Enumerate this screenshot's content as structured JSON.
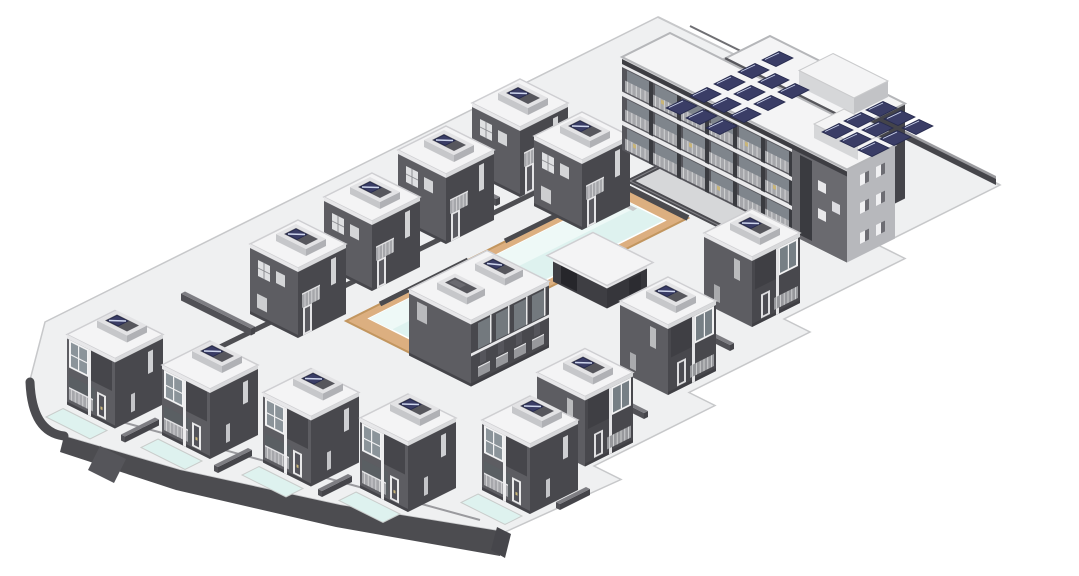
{
  "canvas": {
    "width": 1079,
    "height": 576,
    "background": "#ffffff"
  },
  "colors": {
    "pad": "#eff0f1",
    "pad_edge_line": "#c7c8ca",
    "curb": "#4c4c50",
    "curb_light": "#9a9a9e",
    "wall_dark": "#46464b",
    "wall_top": "#7e7e83",
    "villa_sw": "#5d5d62",
    "villa_se": "#48484d",
    "roof": "#f4f4f5",
    "roof_edge": "#cfcfd2",
    "parapet": "#e7e7e9",
    "well_ring_sw": "#c6c7ca",
    "well_ring_se": "#b0b1b5",
    "well_ring_top": "#e3e3e5",
    "well_dark": "#57575d",
    "solar": "#3a3d66",
    "solar_dark": "#262a4d",
    "solar_streak": "#cdd5ec",
    "glass": "#8b949a",
    "frame": "#f2f2f3",
    "railing": "#a6a7ab",
    "railing_line": "#d8d9da",
    "door_dark": "#53535a",
    "accent": "#c9b578",
    "pool_water": "#def2ef",
    "pool_light": "#eef9f7",
    "deck": "#dcaf80",
    "deck_edge": "#c2965f",
    "apt_facade": "#55555b",
    "apt_glass": "#7f858c",
    "apt_slab": "#e9e9eb",
    "apt_mullion": "#3a3b40",
    "apt_parapet": "#3e3e43",
    "tower_light": "#b7b8bc",
    "tower_sw": "#6a6a6f",
    "pit_floor": "#d6d7d9",
    "step_light": "#eeeeef",
    "step_dark": "#c6c7c9"
  },
  "iso": {
    "ox": 660,
    "oy": 16,
    "ux": 1,
    "uy": 0.5
  },
  "site": {
    "pad_path": "M658,17 L1000,185 L879,245.5 L905,258.5 L784,319 L810,332 L689,392.5 L715,405.5 L594,466 L621,479.5 L505,532 L340,505 L180,470 L64,436 Q30,432 30,380 L45,322 Z",
    "edge_face": [
      [
        64,
        436
      ],
      [
        180,
        470
      ],
      [
        340,
        505
      ],
      [
        505,
        532
      ],
      [
        500,
        556
      ],
      [
        336,
        527
      ],
      [
        176,
        490
      ],
      [
        60,
        452
      ]
    ],
    "cap_band": "M64,436 Q32,432 30,382",
    "corner_notch": [
      [
        497,
        527
      ],
      [
        511,
        534
      ],
      [
        505,
        558
      ],
      [
        491,
        550
      ]
    ],
    "road_stub": [
      [
        100,
        446
      ],
      [
        126,
        459
      ],
      [
        114,
        483
      ],
      [
        88,
        470
      ]
    ],
    "inner_curb": "M620,151 L128,392",
    "front_curb": "M115,420 L480,520",
    "ne_edge_line": [
      [
        658,
        17
      ],
      [
        1000,
        185
      ]
    ],
    "ne_edge_line2": [
      [
        690,
        26
      ],
      [
        850,
        105
      ]
    ],
    "ne_wall": [
      [
        852,
        106
      ],
      [
        996,
        178
      ],
      [
        996,
        185
      ],
      [
        852,
        113
      ]
    ],
    "ne_wall_top": [
      [
        850,
        103
      ],
      [
        996,
        176
      ],
      [
        996,
        179
      ],
      [
        850,
        106
      ]
    ]
  },
  "pool": {
    "deck": {
      "x": 148,
      "y": 188,
      "w": 68,
      "d": 274
    },
    "water": {
      "x": 157,
      "y": 202,
      "w": 50,
      "d": 246
    },
    "nw_walls": [
      [
        [
          620,
          184
        ],
        [
          505,
          241
        ]
      ],
      [
        [
          468,
          260
        ],
        [
          380,
          304
        ]
      ]
    ],
    "ne_wall": [
      [
        620,
        184
      ],
      [
        688,
        218
      ]
    ],
    "stairs": {
      "x": 596,
      "y": 188,
      "steps": 4
    }
  },
  "pit": {
    "x": 150,
    "y": 138,
    "w": 112,
    "d": 42
  },
  "villas": [
    {
      "id": "villa-top-1",
      "x": 93,
      "y": 455,
      "w": 48,
      "d": 48,
      "h": 70,
      "variant": "back",
      "pool": false
    },
    {
      "id": "villa-top-2",
      "x": 83,
      "y": 371,
      "w": 48,
      "d": 48,
      "h": 70,
      "variant": "back",
      "pool": false
    },
    {
      "id": "villa-top-3",
      "x": 73,
      "y": 287,
      "w": 48,
      "d": 48,
      "h": 70,
      "variant": "back",
      "pool": false
    },
    {
      "id": "villa-top-4",
      "x": 63,
      "y": 203,
      "w": 48,
      "d": 48,
      "h": 70,
      "variant": "back",
      "pool": false
    },
    {
      "id": "villa-top-5",
      "x": 127,
      "y": 205,
      "w": 48,
      "d": 48,
      "h": 70,
      "variant": "back",
      "pool": false
    },
    {
      "id": "villa-bottom-1",
      "x": 92,
      "y": 637,
      "w": 48,
      "d": 48,
      "h": 70,
      "variant": "front",
      "pool": true
    },
    {
      "id": "villa-bottom-2",
      "x": 170,
      "y": 620,
      "w": 48,
      "d": 48,
      "h": 70,
      "variant": "front",
      "pool": true
    },
    {
      "id": "villa-bottom-3",
      "x": 248,
      "y": 597,
      "w": 48,
      "d": 48,
      "h": 70,
      "variant": "front",
      "pool": true
    },
    {
      "id": "villa-bottom-4",
      "x": 322,
      "y": 574,
      "w": 48,
      "d": 48,
      "h": 70,
      "variant": "front",
      "pool": true
    },
    {
      "id": "villa-bottom-5",
      "x": 385,
      "y": 515,
      "w": 48,
      "d": 48,
      "h": 70,
      "variant": "front",
      "pool": true
    },
    {
      "id": "villa-right-1",
      "x": 309,
      "y": 217,
      "w": 48,
      "d": 48,
      "h": 70,
      "variant": "se",
      "pool": false
    },
    {
      "id": "villa-right-2",
      "x": 335,
      "y": 327,
      "w": 48,
      "d": 48,
      "h": 70,
      "variant": "se",
      "pool": false
    },
    {
      "id": "villa-right-3",
      "x": 365,
      "y": 440,
      "w": 48,
      "d": 48,
      "h": 70,
      "variant": "se",
      "pool": false
    },
    {
      "id": "villa-duplex",
      "x": 214,
      "y": 387,
      "w": 62,
      "d": 78,
      "h": 66,
      "variant": "duplex",
      "pool": false
    },
    {
      "id": "pool-cabana",
      "x": 212,
      "y": 279,
      "w": 54,
      "d": 40,
      "h": 26,
      "variant": "cabana",
      "pool": false
    }
  ],
  "walls": [
    {
      "x": 30,
      "y": 268,
      "w": 78,
      "d": 4,
      "h": 7
    },
    {
      "x": 30,
      "y": 352,
      "w": 78,
      "d": 4,
      "h": 7
    },
    {
      "x": 35,
      "y": 436,
      "w": 78,
      "d": 4,
      "h": 7
    },
    {
      "x": 45,
      "y": 520,
      "w": 70,
      "d": 4,
      "h": 7
    },
    {
      "x": 155,
      "y": 660,
      "w": 4,
      "d": 34,
      "h": 6
    },
    {
      "x": 232,
      "y": 644,
      "w": 4,
      "d": 34,
      "h": 6
    },
    {
      "x": 308,
      "y": 620,
      "w": 4,
      "d": 30,
      "h": 6
    },
    {
      "x": 358,
      "y": 574,
      "w": 4,
      "d": 34,
      "h": 6
    },
    {
      "x": 440,
      "y": 514,
      "w": 4,
      "d": 30,
      "h": 6
    },
    {
      "x": 320,
      "y": 296,
      "w": 50,
      "d": 4,
      "h": 6
    },
    {
      "x": 345,
      "y": 407,
      "w": 50,
      "d": 4,
      "h": 6
    }
  ],
  "apartment": {
    "bar_back": {
      "x": 170,
      "y": 60,
      "w": 135,
      "d": 45,
      "h": 95
    },
    "bar_front": {
      "x": 115,
      "y": 105,
      "w": 225,
      "d": 48,
      "h": 93,
      "facade_end": 170
    },
    "bulkheads": [
      {
        "x": 235,
        "y": 62,
        "w": 55,
        "d": 34,
        "h": 16,
        "base": 95
      },
      {
        "x": 292,
        "y": 108,
        "w": 44,
        "d": 30,
        "h": 14,
        "base": 93
      }
    ],
    "solar_clusters": [
      {
        "origin": [
          666,
          108
        ],
        "rows": [
          5,
          4,
          4
        ],
        "col_step": [
          24,
          -12
        ],
        "row_step": [
          20,
          10
        ]
      },
      {
        "origin": [
          822,
          132
        ],
        "rows": [
          3,
          3,
          3
        ],
        "col_step": [
          22,
          -11
        ],
        "row_step": [
          18,
          9
        ]
      }
    ],
    "floors": 3,
    "bays": 6
  }
}
